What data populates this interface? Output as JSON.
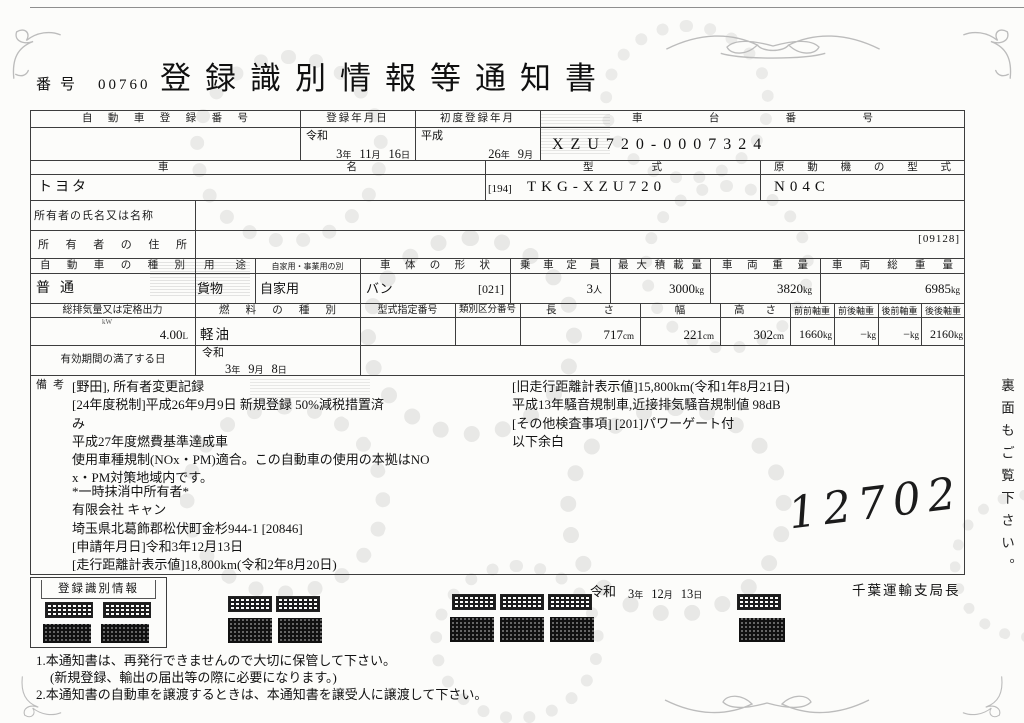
{
  "doc": {
    "number_label": "番号",
    "number_value": "00760",
    "title": "登録識別情報等通知書"
  },
  "units": {
    "year": "年",
    "month": "月",
    "day": "日",
    "person": "人",
    "kg": "kg",
    "cm": "cm",
    "kw": "kW",
    "liter": "L"
  },
  "row1": {
    "h_car_no": "自動車登録番号",
    "h_reg_date": "登録年月日",
    "h_first_reg": "初度登録年月",
    "h_chassis": "車台番号",
    "reg_era": "令和",
    "reg_y": "3",
    "reg_m": "11",
    "reg_d": "16",
    "first_era": "平成",
    "first_y": "26",
    "first_m": "9",
    "chassis": "XZU720-0007324"
  },
  "row2": {
    "h_name": "車名",
    "h_model": "型式",
    "h_engine": "原動機の型式",
    "name": "トヨタ",
    "model_code": "[194]",
    "model": "TKG-XZU720",
    "engine": "N04C"
  },
  "owner": {
    "h_name": "所有者の氏名又は名称",
    "h_address": "所有者の住所",
    "address_code": "[09128]"
  },
  "row5": {
    "h_kind": "自動車の種別",
    "h_use": "用途",
    "h_private": "自家用・事業用の別",
    "h_body": "車体の形状",
    "h_capacity": "乗車定員",
    "h_payload": "最大積載量",
    "h_weight": "車両重量",
    "h_gross": "車両総重量",
    "kind": "普通",
    "use": "貨物",
    "private": "自家用",
    "body": "バン",
    "body_code": "[021]",
    "capacity": "3",
    "payload": "3000",
    "weight": "3820",
    "gross": "6985"
  },
  "row6": {
    "h_displacement": "総排気量又は定格出力",
    "h_fuel": "燃料の種別",
    "h_type_no": "型式指定番号",
    "h_class_no": "類別区分番号",
    "h_length": "長さ",
    "h_width": "幅",
    "h_height": "高さ",
    "h_axle_ff": "前前軸重",
    "h_axle_fr": "前後軸重",
    "h_axle_rf": "後前軸重",
    "h_axle_rr": "後後軸重",
    "displacement": "4.00",
    "fuel": "軽油",
    "length": "717",
    "width": "221",
    "height": "302",
    "axle_ff": "1660",
    "axle_fr": "−",
    "axle_rf": "−",
    "axle_rr": "2160"
  },
  "validity": {
    "label": "有効期間の満了する日",
    "era": "令和",
    "y": "3",
    "m": "9",
    "d": "8"
  },
  "remarks": {
    "label": "備考",
    "left_top": [
      "[野田], 所有者変更記録",
      "[24年度税制]平成26年9月9日 新規登録 50%減税措置済",
      "み",
      "平成27年度燃費基準達成車",
      "使用車種規制(NOx・PM)適合。この自動車の使用の本拠はNO",
      "x・PM対策地域内です。"
    ],
    "left_bottom": [
      "*一時抹消中所有者*",
      "有限会社 キャン",
      "埼玉県北葛飾郡松伏町金杉944-1 [20846]",
      "[申請年月日]令和3年12月13日",
      "[走行距離計表示値]18,800km(令和2年8月20日)"
    ],
    "right": [
      "[旧走行距離計表示値]15,800km(令和1年8月21日)",
      "平成13年騒音規制車,近接排気騒音規制値 98dB",
      "[その他検査事項] [201]パワーゲート付",
      "以下余白"
    ],
    "handwritten": "12702"
  },
  "issue": {
    "era": "令和",
    "y": "3",
    "m": "12",
    "d": "13",
    "office": "千葉運輸支局長"
  },
  "qr_section": {
    "label": "登録識別情報"
  },
  "footer": {
    "note1": "1.本通知書は、再発行できませんので大切に保管して下さい。",
    "note1b": "(新規登録、輸出の届出等の際に必要になります。)",
    "note2": "2.本通知書の自動車を譲渡するときは、本通知書を譲受人に譲渡して下さい。"
  },
  "side_note": "裏面もご覧下さい。"
}
